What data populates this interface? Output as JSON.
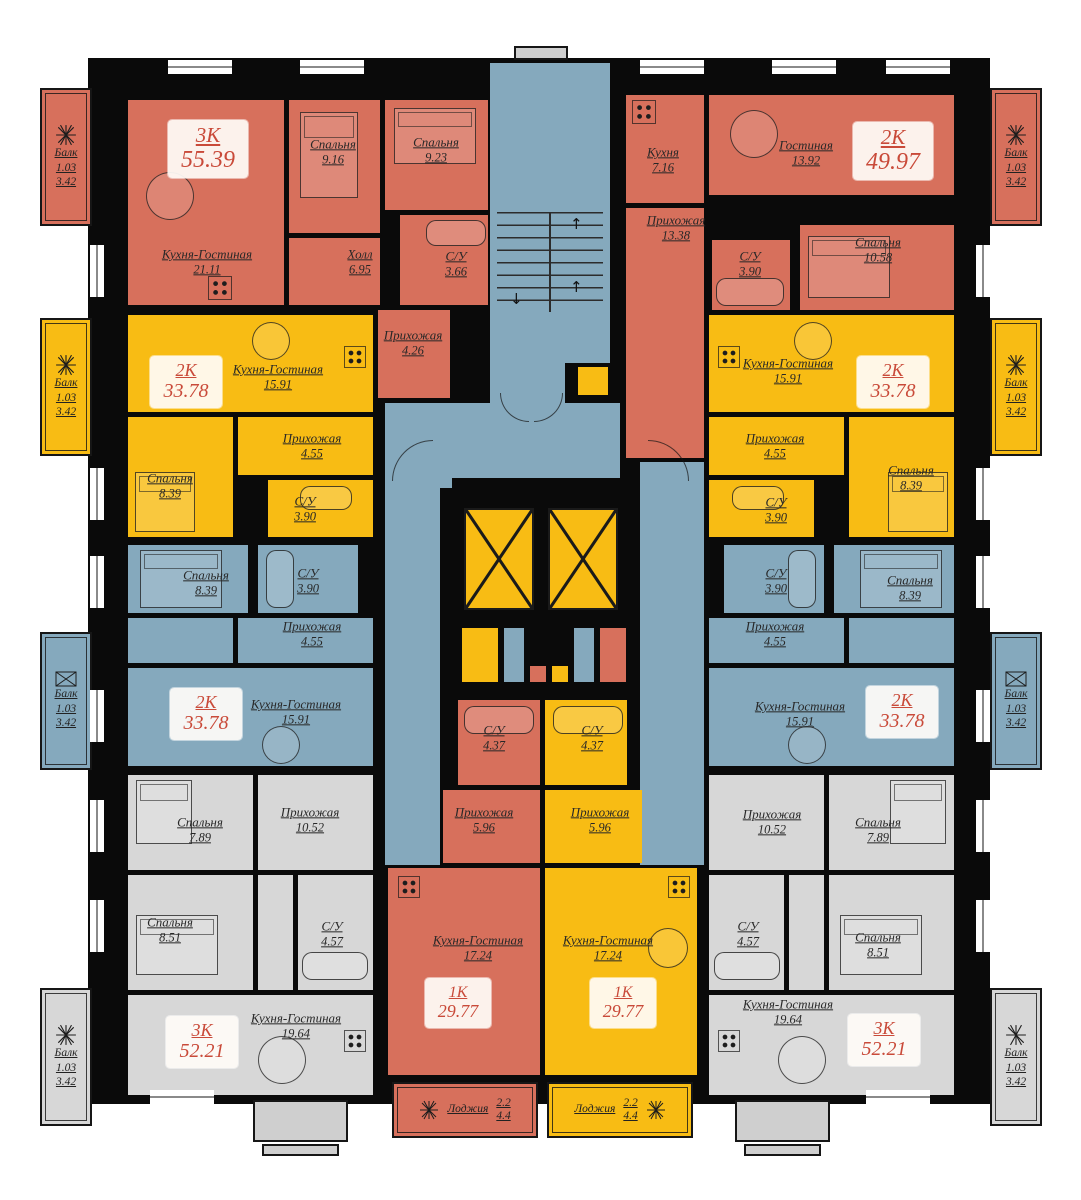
{
  "colors": {
    "apartment_red": "#D7705C",
    "apartment_yellow": "#F8BC14",
    "apartment_blue": "#85A9BD",
    "apartment_gray": "#D7D7D7",
    "walls": "#0a0a0a",
    "badge_text": "#C94A39",
    "label_text": "#272727"
  },
  "icons": {
    "balcony_marker": "ac-unit-star",
    "elevator_marker": "elevator-x-box"
  },
  "apartments": [
    {
      "id": "top-left-red",
      "type_label": "3К",
      "total_area": "55.39",
      "color": "#D7705C",
      "rooms": [
        {
          "name": "Кухня-Гостиная",
          "area": "21.11"
        },
        {
          "name": "Спальня",
          "area": "9.16"
        },
        {
          "name": "Спальня",
          "area": "9.23"
        },
        {
          "name": "Холл",
          "area": "6.95"
        },
        {
          "name": "С/У",
          "area": "3.66"
        },
        {
          "name": "Прихожая",
          "area": "4.26"
        }
      ],
      "balcony": {
        "label": "Балк",
        "area1": "1.03",
        "area2": "3.42"
      }
    },
    {
      "id": "top-right-red",
      "type_label": "2К",
      "total_area": "49.97",
      "color": "#D7705C",
      "rooms": [
        {
          "name": "Кухня",
          "area": "7.16"
        },
        {
          "name": "Гостиная",
          "area": "13.92"
        },
        {
          "name": "Прихожая",
          "area": "13.38"
        },
        {
          "name": "С/У",
          "area": "3.90"
        },
        {
          "name": "Спальня",
          "area": "10.58"
        }
      ],
      "balcony": {
        "label": "Балк",
        "area1": "1.03",
        "area2": "3.42"
      }
    },
    {
      "id": "mid-left-yellow",
      "type_label": "2К",
      "total_area": "33.78",
      "color": "#F8BC14",
      "rooms": [
        {
          "name": "Кухня-Гостиная",
          "area": "15.91"
        },
        {
          "name": "Прихожая",
          "area": "4.55"
        },
        {
          "name": "Спальня",
          "area": "8.39"
        },
        {
          "name": "С/У",
          "area": "3.90"
        }
      ],
      "balcony": {
        "label": "Балк",
        "area1": "1.03",
        "area2": "3.42"
      }
    },
    {
      "id": "mid-right-yellow",
      "type_label": "2К",
      "total_area": "33.78",
      "color": "#F8BC14",
      "rooms": [
        {
          "name": "Кухня-Гостиная",
          "area": "15.91"
        },
        {
          "name": "Прихожая",
          "area": "4.55"
        },
        {
          "name": "Спальня",
          "area": "8.39"
        },
        {
          "name": "С/У",
          "area": "3.90"
        }
      ],
      "balcony": {
        "label": "Балк",
        "area1": "1.03",
        "area2": "3.42"
      }
    },
    {
      "id": "mid-left-blue",
      "type_label": "2К",
      "total_area": "33.78",
      "color": "#85A9BD",
      "rooms": [
        {
          "name": "Спальня",
          "area": "8.39"
        },
        {
          "name": "С/У",
          "area": "3.90"
        },
        {
          "name": "Прихожая",
          "area": "4.55"
        },
        {
          "name": "Кухня-Гостиная",
          "area": "15.91"
        }
      ],
      "balcony": {
        "label": "Балк",
        "area1": "1.03",
        "area2": "3.42"
      }
    },
    {
      "id": "mid-right-blue",
      "type_label": "2К",
      "total_area": "33.78",
      "color": "#85A9BD",
      "rooms": [
        {
          "name": "С/У",
          "area": "3.90"
        },
        {
          "name": "Спальня",
          "area": "8.39"
        },
        {
          "name": "Прихожая",
          "area": "4.55"
        },
        {
          "name": "Кухня-Гостиная",
          "area": "15.91"
        }
      ],
      "balcony": {
        "label": "Балк",
        "area1": "1.03",
        "area2": "3.42"
      }
    },
    {
      "id": "bottom-left-gray",
      "type_label": "3К",
      "total_area": "52.21",
      "color": "#D7D7D7",
      "rooms": [
        {
          "name": "Спальня",
          "area": "7.89"
        },
        {
          "name": "Прихожая",
          "area": "10.52"
        },
        {
          "name": "Спальня",
          "area": "8.51"
        },
        {
          "name": "С/У",
          "area": "4.57"
        },
        {
          "name": "Кухня-Гостиная",
          "area": "19.64"
        }
      ],
      "balcony": {
        "label": "Балк",
        "area1": "1.03",
        "area2": "3.42"
      }
    },
    {
      "id": "bottom-right-gray",
      "type_label": "3К",
      "total_area": "52.21",
      "color": "#D7D7D7",
      "rooms": [
        {
          "name": "Прихожая",
          "area": "10.52"
        },
        {
          "name": "Спальня",
          "area": "7.89"
        },
        {
          "name": "С/У",
          "area": "4.57"
        },
        {
          "name": "Спальня",
          "area": "8.51"
        },
        {
          "name": "Кухня-Гостиная",
          "area": "19.64"
        }
      ],
      "balcony": {
        "label": "Балк",
        "area1": "1.03",
        "area2": "3.42"
      }
    },
    {
      "id": "bottom-center-red",
      "type_label": "1К",
      "total_area": "29.77",
      "color": "#D7705C",
      "rooms": [
        {
          "name": "С/У",
          "area": "4.37"
        },
        {
          "name": "Прихожая",
          "area": "5.96"
        },
        {
          "name": "Кухня-Гостиная",
          "area": "17.24"
        }
      ],
      "loggia": {
        "label": "Лоджия",
        "area1": "2.2",
        "area2": "4.4"
      }
    },
    {
      "id": "bottom-center-yellow",
      "type_label": "1К",
      "total_area": "29.77",
      "color": "#F8BC14",
      "rooms": [
        {
          "name": "С/У",
          "area": "4.37"
        },
        {
          "name": "Прихожая",
          "area": "5.96"
        },
        {
          "name": "Кухня-Гостиная",
          "area": "17.24"
        }
      ],
      "loggia": {
        "label": "Лоджия",
        "area1": "2.2",
        "area2": "4.4"
      }
    }
  ]
}
